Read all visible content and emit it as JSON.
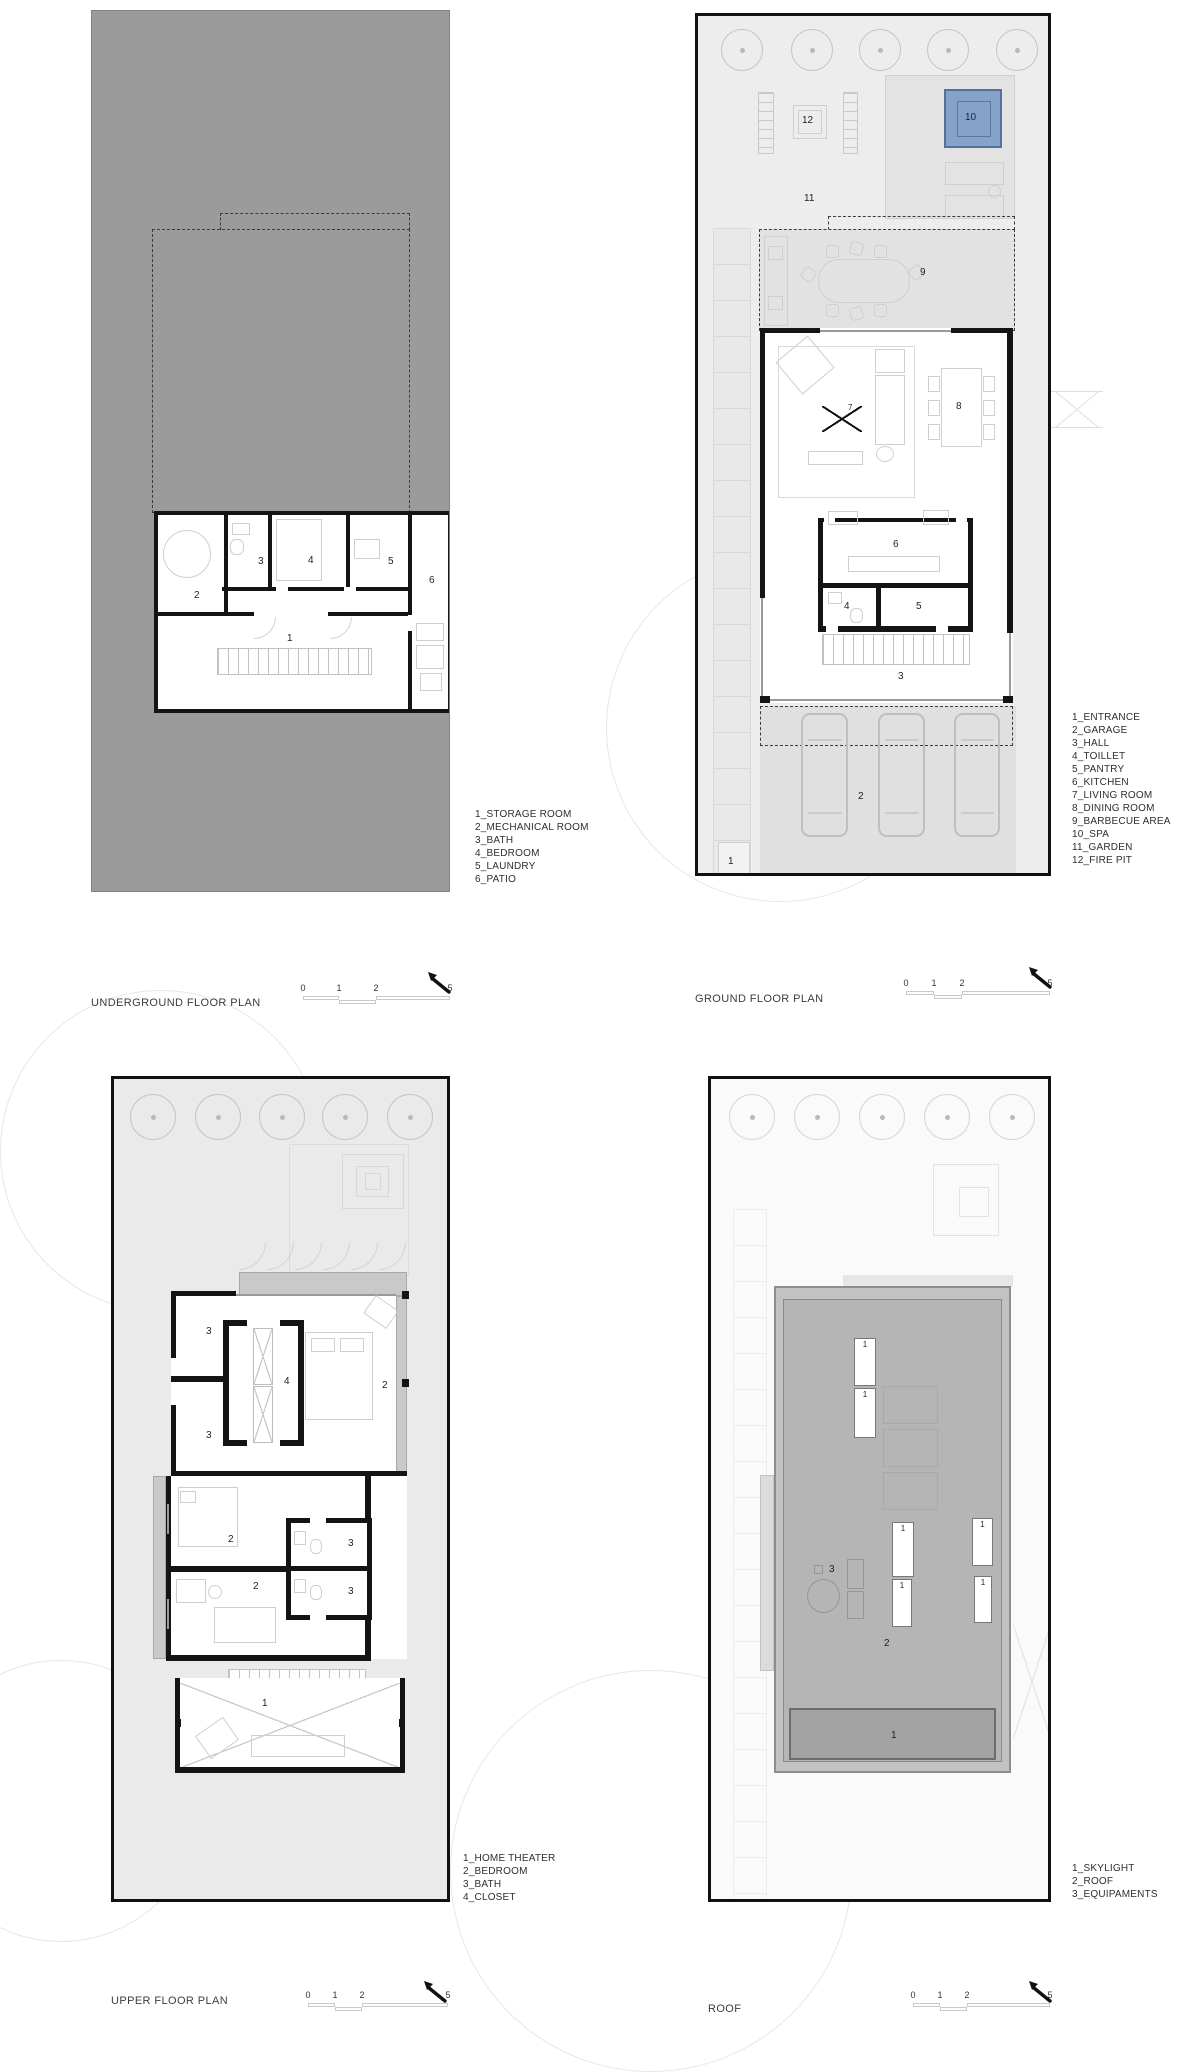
{
  "document": {
    "background": "#ffffff"
  },
  "colors": {
    "underground_site": "#9b9b9b",
    "site_light": "#ebebeb",
    "wall": "#141414",
    "spa_fill": "#87a2c9",
    "spa_border": "#51719e",
    "roof_fill": "#b5b5b5",
    "roof_skylight_band": "#a3a3a3",
    "deck": "#e3e3e3",
    "garage": "#e0e0e0"
  },
  "scalebar": {
    "ticks": [
      "0",
      "1",
      "2",
      "5"
    ]
  },
  "plans": [
    {
      "id": "underground",
      "title": "UNDERGROUND FLOOR PLAN",
      "legend": [
        "1_STORAGE ROOM",
        "2_MECHANICAL ROOM",
        "3_BATH",
        "4_BEDROOM",
        "5_LAUNDRY",
        "6_PATIO"
      ],
      "rooms": [
        "1",
        "2",
        "3",
        "4",
        "5",
        "6"
      ]
    },
    {
      "id": "ground",
      "title": "GROUND FLOOR PLAN",
      "legend": [
        "1_ENTRANCE",
        "2_GARAGE",
        "3_HALL",
        "4_TOILLET",
        "5_PANTRY",
        "6_KITCHEN",
        "7_LIVING ROOM",
        "8_DINING ROOM",
        "9_BARBECUE AREA",
        "10_SPA",
        "11_GARDEN",
        "12_FIRE PIT"
      ],
      "rooms": [
        "1",
        "2",
        "3",
        "4",
        "5",
        "6",
        "7",
        "8",
        "9",
        "10",
        "11",
        "12"
      ]
    },
    {
      "id": "upper",
      "title": "UPPER FLOOR PLAN",
      "legend": [
        "1_HOME THEATER",
        "2_BEDROOM",
        "3_BATH",
        "4_CLOSET"
      ],
      "rooms": [
        "1",
        "2",
        "3",
        "4"
      ]
    },
    {
      "id": "roof",
      "title": "ROOF",
      "legend": [
        "1_SKYLIGHT",
        "2_ROOF",
        "3_EQUIPAMENTS"
      ],
      "rooms": [
        "1",
        "2",
        "3"
      ]
    }
  ]
}
